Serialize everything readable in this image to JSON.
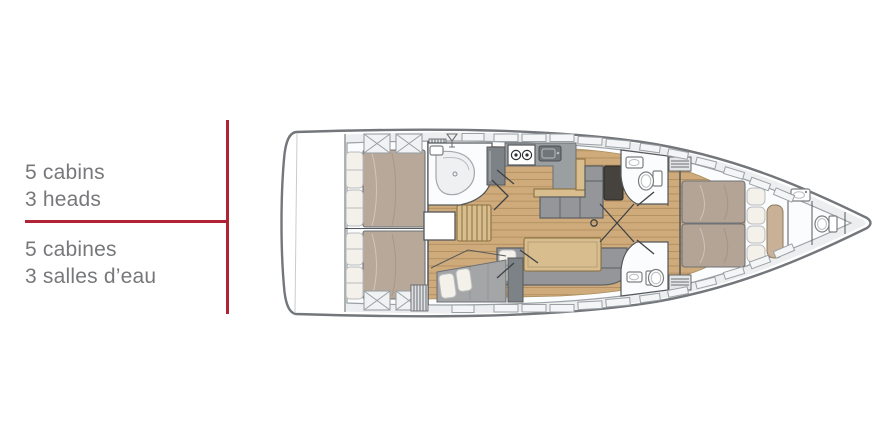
{
  "page": {
    "background_color": "#ffffff"
  },
  "colors": {
    "accent-red": "#b02334",
    "text-gray": "#77787b",
    "hull-stroke": "#73767a",
    "wall": "#55585a",
    "deck": "#eceeef",
    "deck-line": "#9aa0a3",
    "wood": "#cfab7b",
    "wood-line": "#8a6f3f",
    "wood-light": "#d8bd8e",
    "mattress": "#b7a89a",
    "mattress-fwd": "#b3a496",
    "pillow": "#f4f1ea",
    "sofa": "#94969a",
    "counter": "#9aa0a2",
    "appliance": "#7d8287",
    "dark-table": "#46433e",
    "room-white": "#fbfcfd",
    "berth": "#a3a5a7",
    "bench": "#c9b197"
  },
  "spec_labels": {
    "english": {
      "line1": "5 cabins",
      "line2": "3 heads"
    },
    "french": {
      "line1": "5 cabines",
      "line2": "3 salles d’eau"
    }
  },
  "floorplan": {
    "vessel_view": "lower-deck-plan",
    "orientation": "bow-right",
    "cabins_count": "5",
    "heads_count": "3",
    "areas": [
      "swim-platform",
      "aft-cabin-port",
      "aft-cabin-starboard",
      "aft-head-shower",
      "companionway-stairs",
      "galley",
      "salon-settee",
      "salon-sofa",
      "mid-cabin",
      "forward-head-port",
      "forward-head-starboard",
      "forward-cabin",
      "bow-day-head"
    ]
  }
}
